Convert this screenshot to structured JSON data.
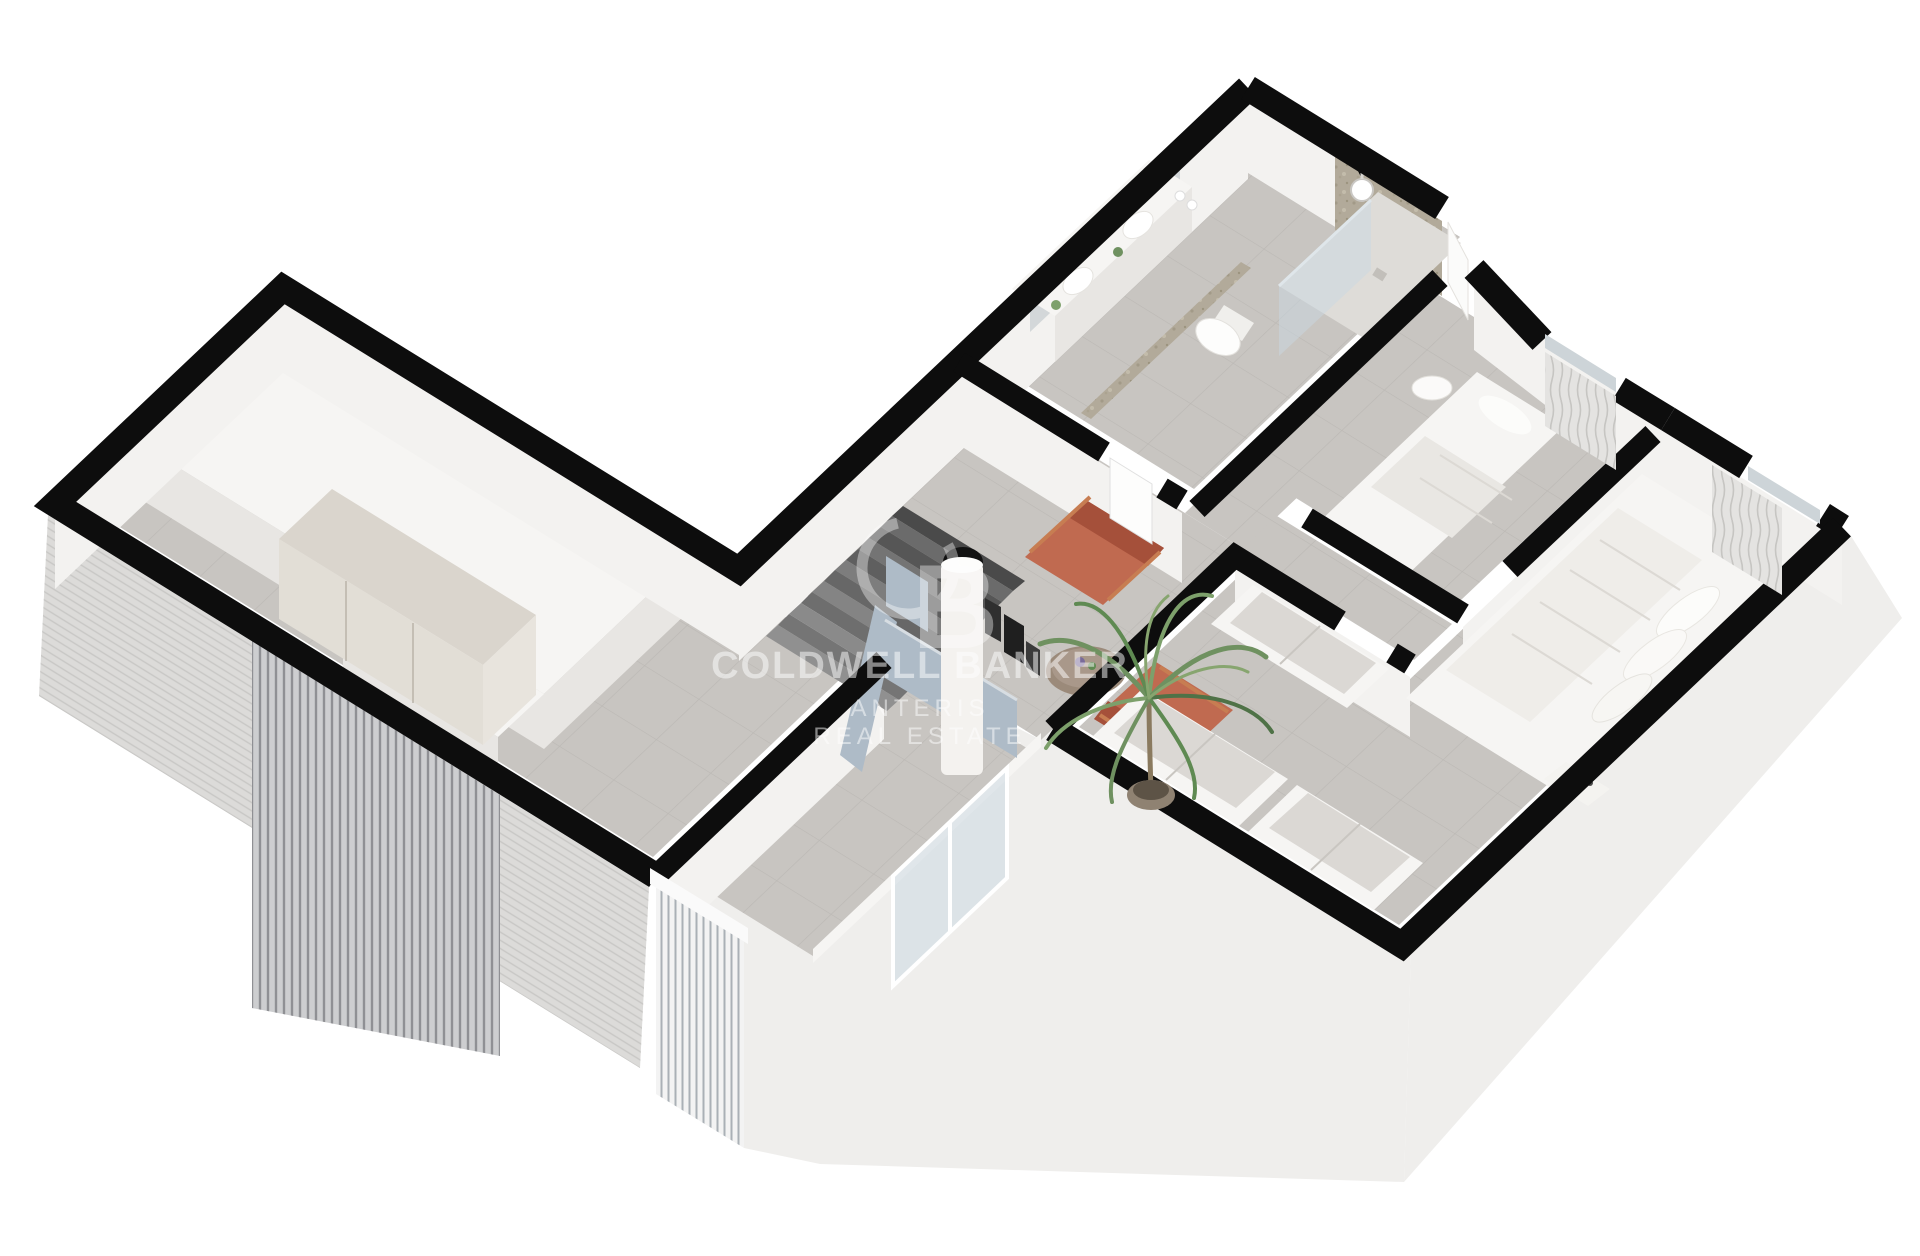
{
  "watermark": {
    "monogram_c": "C",
    "monogram_b": "B",
    "brand": "COLDWELL BANKER",
    "agency_line1": "ANTERIS",
    "agency_line2": "REAL ESTATE"
  },
  "colors": {
    "background": "#ffffff",
    "wall-top": "#0d0d0d",
    "wall-face": "#f3f2f0",
    "wall-face-shade": "#e8e6e3",
    "floor": "#c8c5c1",
    "floor-line": "#b1aeaa",
    "exterior-face": "#efeeec",
    "cladding": "#dcdbd9",
    "slat": "#cdced0",
    "slat-line": "#8f9094",
    "stone": "#b2aa9a",
    "glass": "#c9d8e2",
    "balustrade": "#aebbc7",
    "accent": "#c06a50",
    "accent-dark": "#a5503a",
    "plant": "#6f9160",
    "plant-dark": "#4f7247",
    "wood": "#9b8a7a",
    "furniture-white": "#f6f5f3",
    "dark-object": "#2f2f2f",
    "stair-dark": "#5f5f5f",
    "stair-light": "#7d7d7d",
    "watermark": "#ffffff"
  }
}
